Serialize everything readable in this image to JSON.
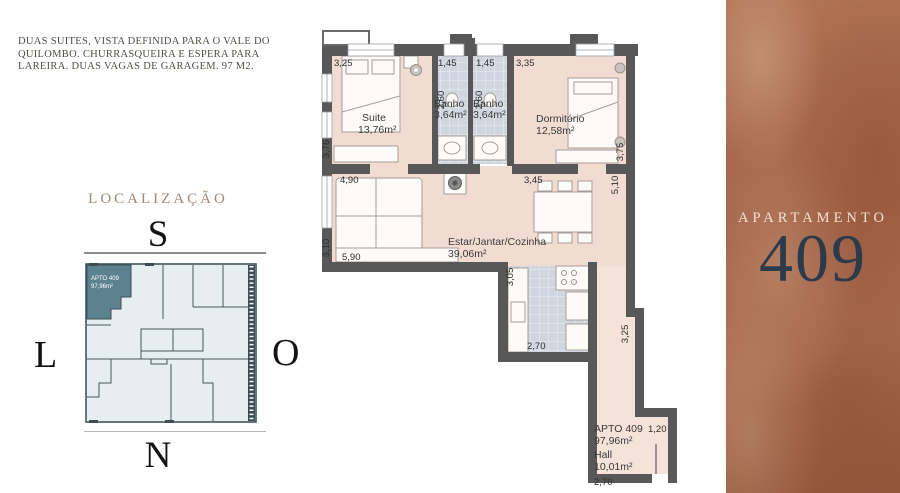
{
  "description": {
    "lines": [
      "DUAS SUITES, VISTA DEFINIDA PARA O VALE DO",
      "QUILOMBO. CHURRASQUEIRA E ESPERA PARA",
      "LAREIRA. DUAS VAGAS DE GARAGEM. 97 M2."
    ]
  },
  "localizacao": {
    "title": "LOCALIZAÇÃO",
    "compass": {
      "south": "S",
      "west": "L",
      "east": "O",
      "north": "N"
    },
    "highlighted_unit": {
      "label": "APTO 409",
      "area": "97,96m²"
    }
  },
  "floorplan": {
    "rooms": {
      "suite": {
        "name": "Suite",
        "area": "13,76m²"
      },
      "banho1": {
        "name": "Banho",
        "area": "3,64m²"
      },
      "banho2": {
        "name": "Banho",
        "area": "3,64m²"
      },
      "dormitorio": {
        "name": "Dormitório",
        "area": "12,58m²"
      },
      "estar": {
        "name": "Estar/Jantar/Cozinha",
        "area": "39,06m²"
      },
      "hall": {
        "apto": "APTO 409",
        "apto_area": "97,96m²",
        "name": "Hall",
        "area": "10,01m²"
      }
    },
    "dims": {
      "suite_top": "3,25",
      "banho1_top": "1,45",
      "banho2_top": "1,45",
      "dorm_top": "3,35",
      "banho1_depth": "2,60",
      "banho2_depth": "2,60",
      "suite_left": "3,76",
      "dorm_right": "3,75",
      "living_top_left": "4,90",
      "living_top_right": "3,45",
      "living_right": "5,10",
      "living_left": "3,10",
      "living_bottom": "5,90",
      "kitchen_left": "3,05",
      "kitchen_bottom": "2,70",
      "corridor_right": "3,25",
      "hall_top_right": "1,20",
      "hall_bottom": "2,70"
    }
  },
  "panel": {
    "title": "APARTAMENTO",
    "number": "409"
  },
  "colors": {
    "panel_background": "#a5674a",
    "panel_number": "#2c3b4c",
    "panel_title": "#f1e2d2",
    "localizacao_title": "#a18875",
    "map_highlight": "#5d828f",
    "map_floor": "#e7eef1",
    "wall": "#585858",
    "floor_pink": "#f2dcd2",
    "floor_tile": "#cfd6df"
  }
}
